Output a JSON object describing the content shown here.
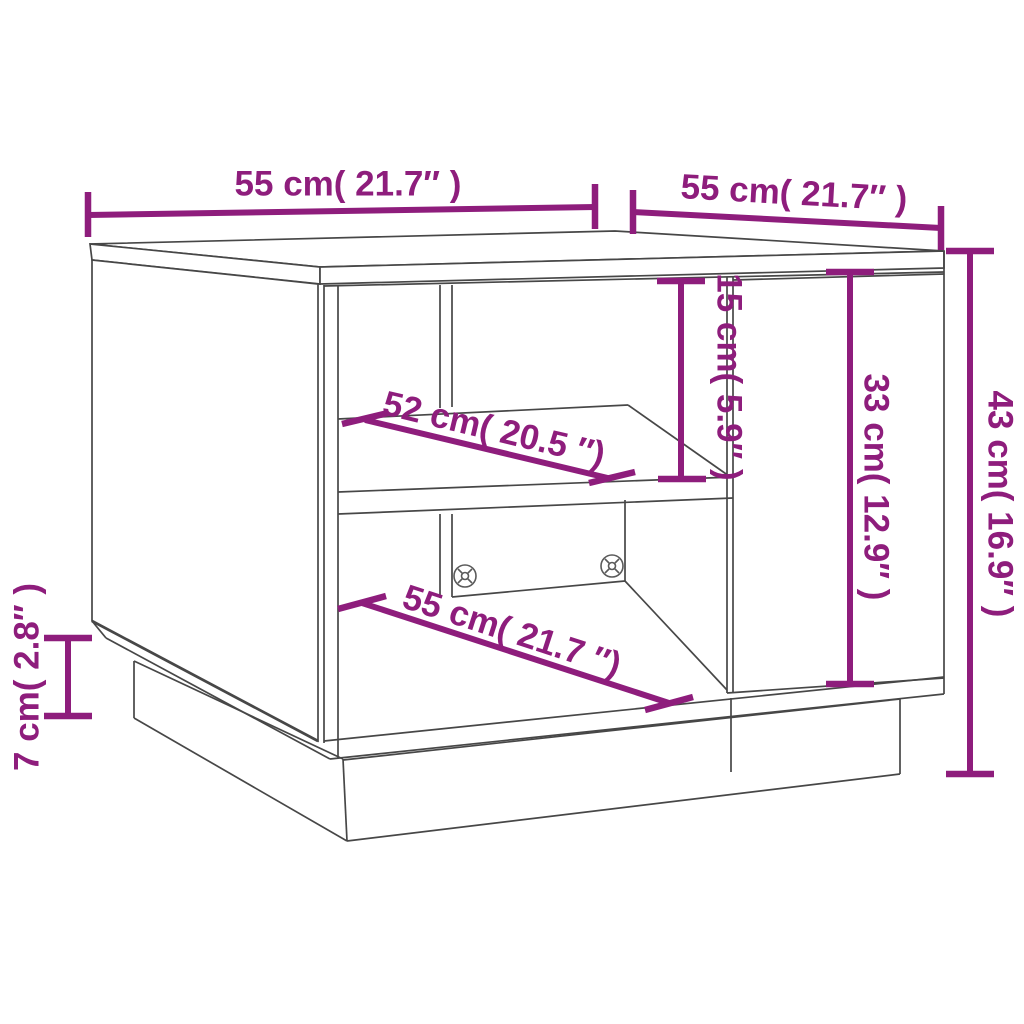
{
  "page": {
    "title": "Coffee table dimension diagram",
    "subject": "coffee-table-line-drawing"
  },
  "style": {
    "accent_color": "#8e1d7c",
    "line_color": "#474747",
    "background": "#ffffff"
  },
  "dims": {
    "top_width": {
      "label": "55 cm( 21.7″ )",
      "value_cm": 55,
      "value_in": 21.7
    },
    "top_depth": {
      "label": "55 cm( 21.7″ )",
      "value_cm": 55,
      "value_in": 21.7
    },
    "height": {
      "label": "43 cm( 16.9″ )",
      "value_cm": 43,
      "value_in": 16.9
    },
    "shelf_opening_height": {
      "label": "15 cm( 5.9″ )",
      "value_cm": 15,
      "value_in": 5.9
    },
    "door_height": {
      "label": "33 cm( 12.9″ )",
      "value_cm": 33,
      "value_in": 12.9
    },
    "shelf_width": {
      "label": "52 cm( 20.5 ″)",
      "value_cm": 52,
      "value_in": 20.5
    },
    "bottom_width": {
      "label": "55 cm( 21.7 ″)",
      "value_cm": 55,
      "value_in": 21.7
    },
    "plinth_height": {
      "label": "7 cm( 2.8″ )",
      "value_cm": 7,
      "value_in": 2.8
    }
  }
}
